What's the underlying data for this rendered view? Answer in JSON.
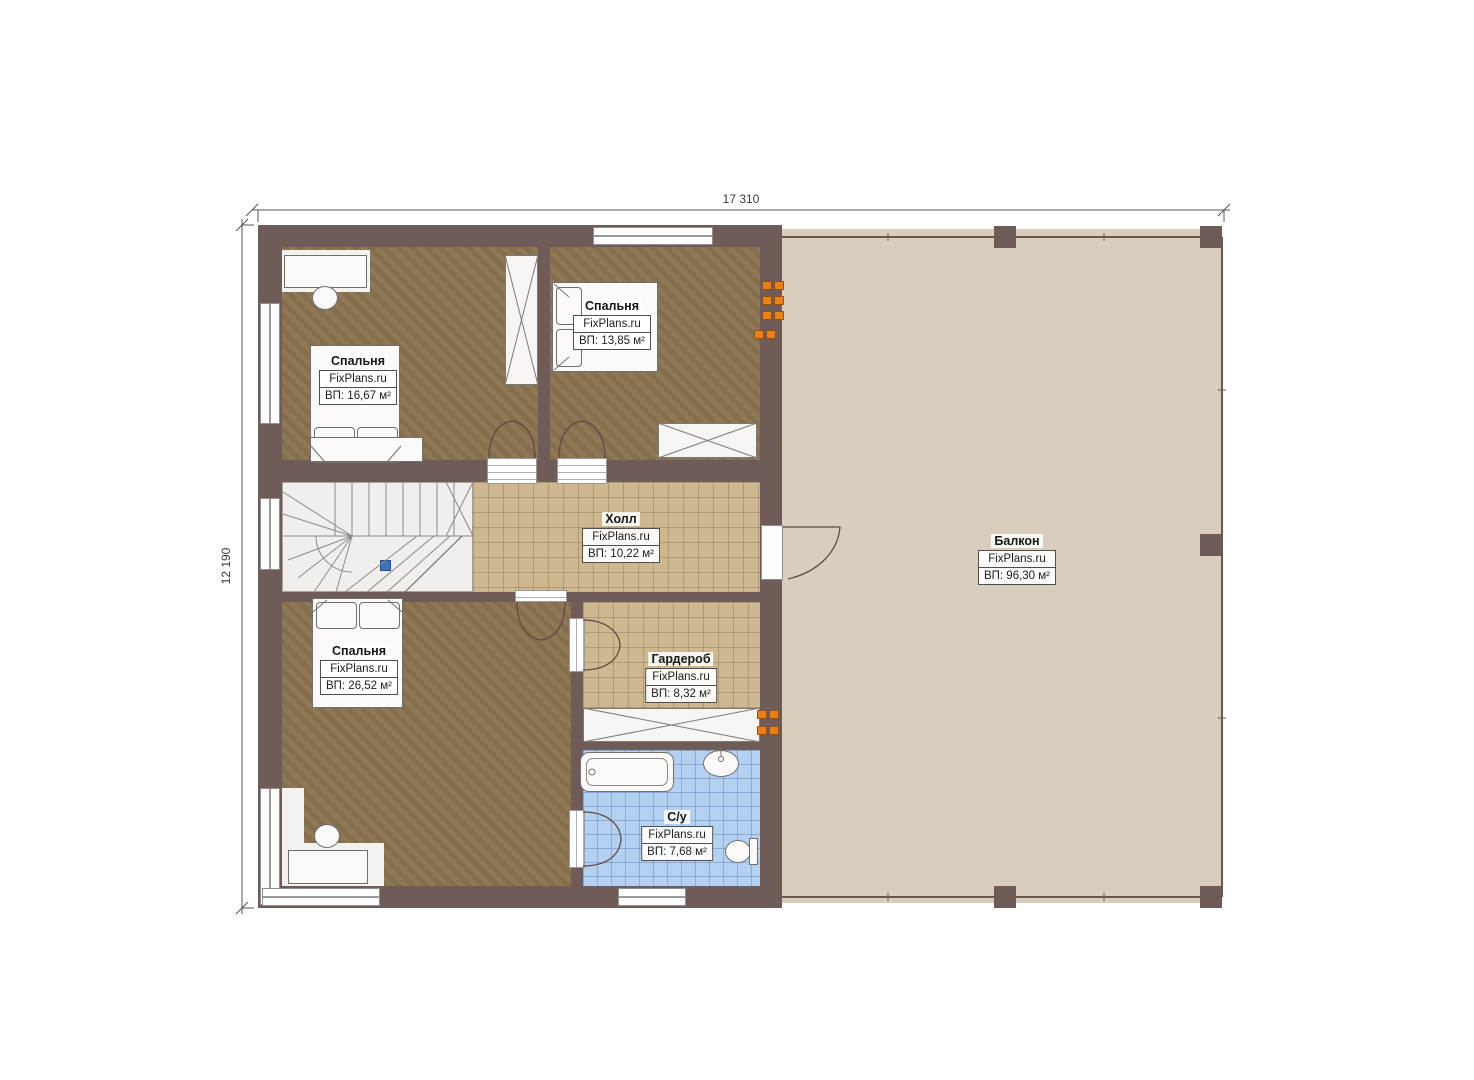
{
  "plan": {
    "type": "floor-plan",
    "brand": "FixPlans.ru",
    "dimensions": {
      "width_label": "17 310",
      "height_label": "12 190"
    },
    "rooms": [
      {
        "id": "bedroom-top-left",
        "name": "Спальня",
        "brand": "FixPlans.ru",
        "area": "ВП: 16,67 м²"
      },
      {
        "id": "bedroom-top-right",
        "name": "Спальня",
        "brand": "FixPlans.ru",
        "area": "ВП: 13,85 м²"
      },
      {
        "id": "hall",
        "name": "Холл",
        "brand": "FixPlans.ru",
        "area": "ВП: 10,22 м²"
      },
      {
        "id": "bedroom-bottom",
        "name": "Спальня",
        "brand": "FixPlans.ru",
        "area": "ВП: 26,52 м²"
      },
      {
        "id": "wardrobe",
        "name": "Гардероб",
        "brand": "FixPlans.ru",
        "area": "ВП: 8,32 м²"
      },
      {
        "id": "bathroom",
        "name": "С/у",
        "brand": "FixPlans.ru",
        "area": "ВП: 7,68 м²"
      },
      {
        "id": "balcony",
        "name": "Балкон",
        "brand": "FixPlans.ru",
        "area": "ВП: 96,30 м²"
      }
    ],
    "colors": {
      "wall": "#6f5c59",
      "bedroom_floor": "#8b7451",
      "tile_tan": "#cdb88f",
      "tile_blue": "#b5d1f2",
      "balcony_floor": "#d9cdbd",
      "marker_orange": "#e8811c",
      "marker_blue": "#3f72b8"
    }
  }
}
